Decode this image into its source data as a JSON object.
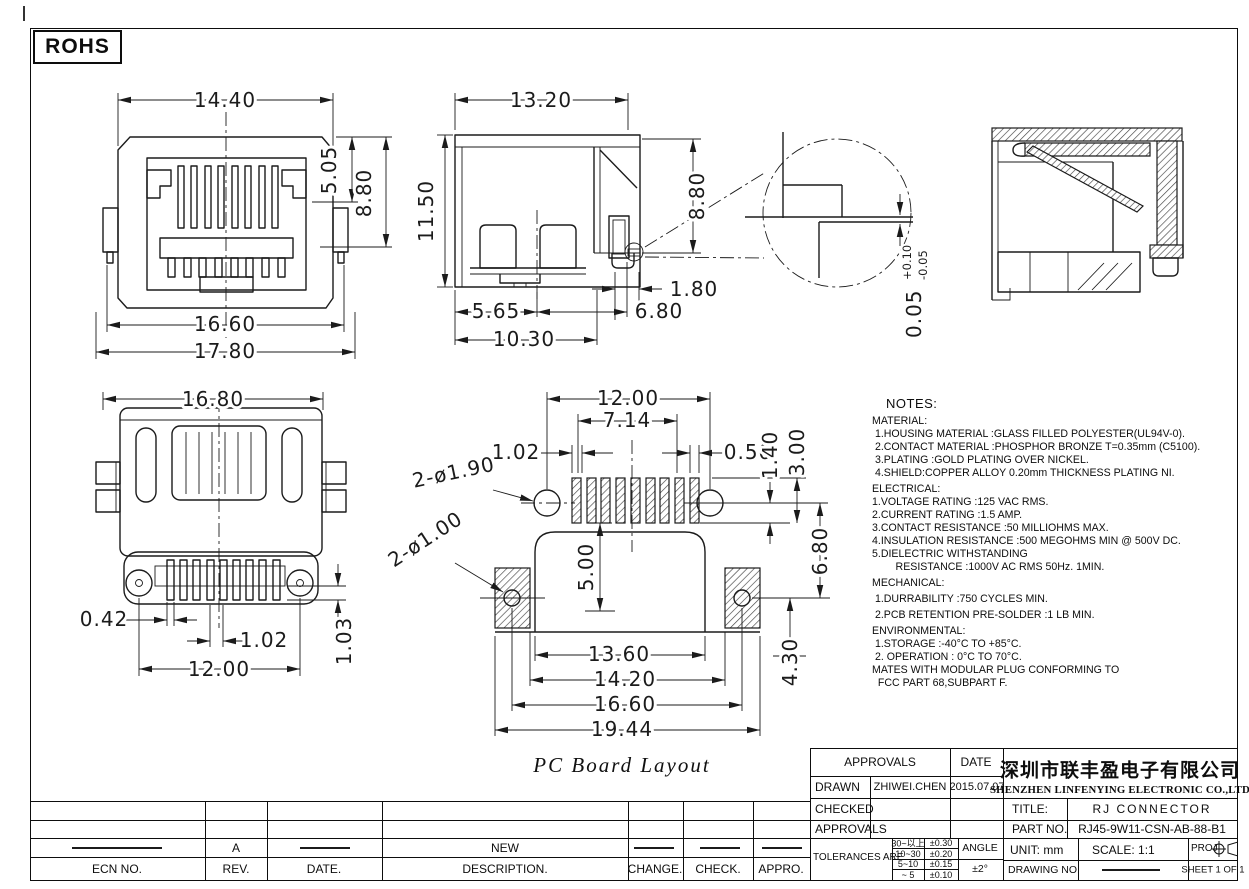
{
  "frame": {
    "rohs": "ROHS"
  },
  "views": {
    "front": {
      "d_width": "14.40",
      "d_h1": "5.05",
      "d_h2": "8.80",
      "d_w1": "16.60",
      "d_w2": "17.80"
    },
    "side": {
      "d_width": "13.20",
      "d_height": "11.50",
      "d_rear": "8.80",
      "d_tab": "1.80",
      "d_b1": "5.65",
      "d_b2": "6.80",
      "d_b3": "10.30"
    },
    "detail": {
      "d": "0.05",
      "tp": "+0.10",
      "tm": "-0.05"
    },
    "bottom": {
      "d_width": "16.80",
      "d_pin": "0.42",
      "d_pitch": "1.02",
      "d_span": "12.00",
      "d_len": "1.03"
    },
    "pcb": {
      "caption": "PC Board Layout",
      "d_span": "12.00",
      "d_pads": "7.14",
      "d_padw": "1.02",
      "d_gap": "0.50",
      "d_r1": "1.40",
      "d_r2": "3.00",
      "d_r3": "6.80",
      "d_v": "5.00",
      "d_w1": "13.60",
      "d_w2": "14.20",
      "d_w3": "16.60",
      "d_w4": "19.44",
      "d_tail": "4.30",
      "label_holes_big": "2-ø1.90",
      "label_holes_small": "2-ø1.00"
    }
  },
  "notes": {
    "title": "NOTES:",
    "lines": [
      "MATERIAL:",
      " 1.HOUSING MATERIAL :GLASS FILLED POLYESTER(UL94V-0).",
      " 2.CONTACT MATERIAL :PHOSPHOR BRONZE T=0.35mm (C5100).",
      " 3.PLATING :GOLD PLATING OVER NICKEL.",
      " 4.SHIELD:COPPER ALLOY 0.20mm THICKNESS PLATING NI.",
      "ELECTRICAL:",
      "1.VOLTAGE RATING :125 VAC RMS.",
      "2.CURRENT RATING :1.5 AMP.",
      "3.CONTACT RESISTANCE :50 MILLIOHMS MAX.",
      "4.INSULATION RESISTANCE :500 MEGOHMS MIN @ 500V DC.",
      "5.DIELECTRIC WITHSTANDING",
      "        RESISTANCE :1000V AC RMS 50Hz. 1MIN.",
      "MECHANICAL:",
      " 1.DURRABILITY :750 CYCLES MIN.",
      " 2.PCB RETENTION PRE-SOLDER :1 LB MIN.",
      "ENVIRONMENTAL:",
      " 1.STORAGE :-40°C TO +85°C.",
      " 2. OPERATION : 0°C TO 70°C.",
      "MATES WITH MODULAR PLUG CONFORMING TO",
      "  FCC PART 68,SUBPART F."
    ]
  },
  "title_block": {
    "approvals": "APPROVALS",
    "date": "DATE",
    "drawn_label": "DRAWN",
    "drawn_name": "ZHIWEI.CHEN",
    "drawn_date": "2015.07.07",
    "checked_label": "CHECKED",
    "approvals_label": "APPROVALS",
    "tolerances_label": "TOLERANCES ARE",
    "tolerances": [
      {
        "range": "30~以上",
        "tol": "±0.30"
      },
      {
        "range": "10~30",
        "tol": "±0.20"
      },
      {
        "range": "5~10",
        "tol": "±0.15"
      },
      {
        "range": "~ 5",
        "tol": "±0.10"
      }
    ],
    "angle_label": "ANGLE",
    "angle_tol": "±2°",
    "company_cn": "深圳市联丰盈电子有限公司",
    "company_en": "SHENZHEN LINFENYING ELECTRONIC CO.,LTD",
    "title_label": "TITLE:",
    "title": "RJ  CONNECTOR",
    "part_label": "PART NO.",
    "part_no": "RJ45-9W11-CSN-AB-88-B1",
    "unit_label": "UNIT: mm",
    "scale_label": "SCALE:  1:1",
    "proj_label": "PROJ:",
    "drawing_label": "DRAWING NO.",
    "sheet_label": "SHEET  1 OF 1"
  },
  "revision_table": {
    "headers": [
      "ECN NO.",
      "REV.",
      "DATE.",
      "DESCRIPTION.",
      "CHANGE.",
      "CHECK.",
      "APPRO."
    ],
    "entries": [
      {
        "rev": "A",
        "description": "NEW"
      }
    ]
  }
}
